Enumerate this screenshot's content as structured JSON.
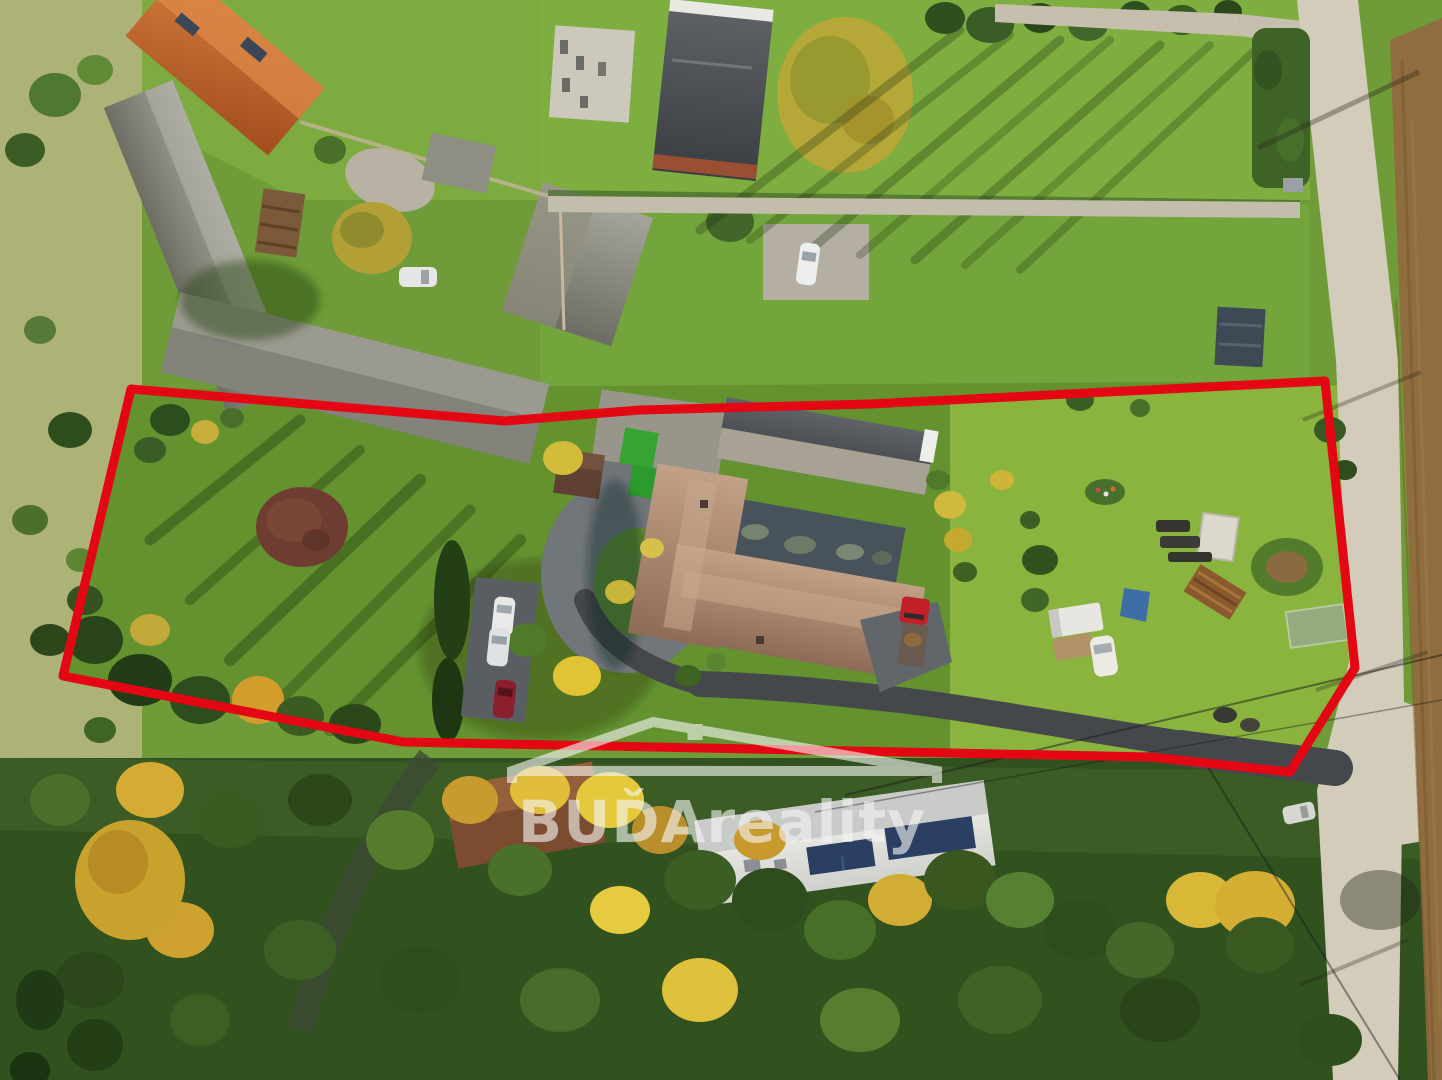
{
  "image": {
    "kind": "aerial-drone-photograph",
    "subject": "real-estate parcel outlined in red, village with farmyards, road and autumn trees"
  },
  "watermark": {
    "text": "BUĎAreality",
    "logo": "house-roof-logo",
    "color": "#f5f5f3",
    "opacity": "0.62"
  },
  "boundary": {
    "color": "#e40613",
    "stroke_width": 9,
    "points_svg": "131,389 505,421 640,410 870,404 1325,381 1355,668 1290,772 1150,757 403,742 63,676"
  },
  "palette": {
    "lawn_green": "#6f9c38",
    "bright_lawn": "#8ab43e",
    "shaded_lawn": "#4c7427",
    "forest_dark": "#31511f",
    "autumn_yellow": "#d9b838",
    "meadow_pale": "#adb277",
    "concrete_road": "#d3ccba",
    "asphalt": "#45484b",
    "plowed_field": "#8f6d3e",
    "tile_roof_orange": "#c05f2c",
    "tile_roof_tan": "#a8806a",
    "roof_gray": "#84837b",
    "roof_dark": "#4a4e52",
    "building_white": "#e9e9e5",
    "turf_green": "#35a433",
    "truck_red": "#c31f28",
    "tarp_blue": "#3e6ea6"
  }
}
